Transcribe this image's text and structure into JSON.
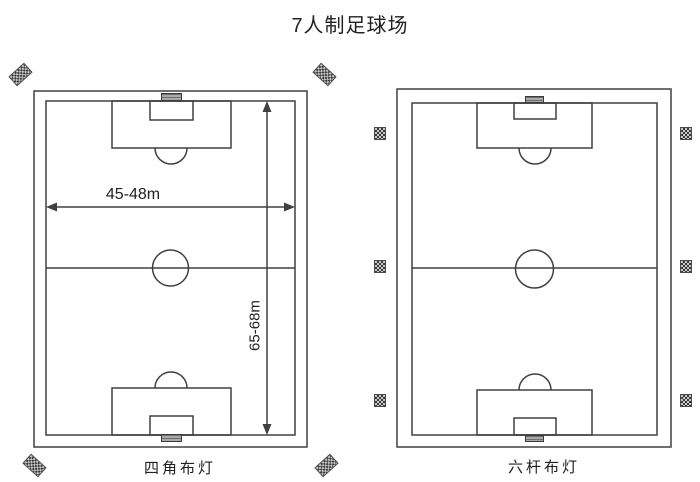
{
  "page": {
    "title": "7人制足球场",
    "background_color": "#ffffff",
    "line_color": "#404040",
    "text_color": "#212121"
  },
  "diagrams": {
    "left": {
      "label": "四角布灯",
      "lighting_scheme": "four-corner floodlights",
      "floodlight_count": 4,
      "floodlight_positions": [
        "top-left",
        "top-right",
        "bottom-left",
        "bottom-right"
      ],
      "dimensions": {
        "width": "45-48m",
        "length": "65-68m"
      }
    },
    "right": {
      "label": "六杆布灯",
      "lighting_scheme": "six-pole floodlights",
      "floodlight_count": 6,
      "floodlight_positions": [
        "left-top",
        "left-middle",
        "left-bottom",
        "right-top",
        "right-middle",
        "right-bottom"
      ]
    }
  },
  "icons": {
    "floodlight": "checkerboard-floodlight-panel",
    "goal": "hatched-goal-marker"
  }
}
